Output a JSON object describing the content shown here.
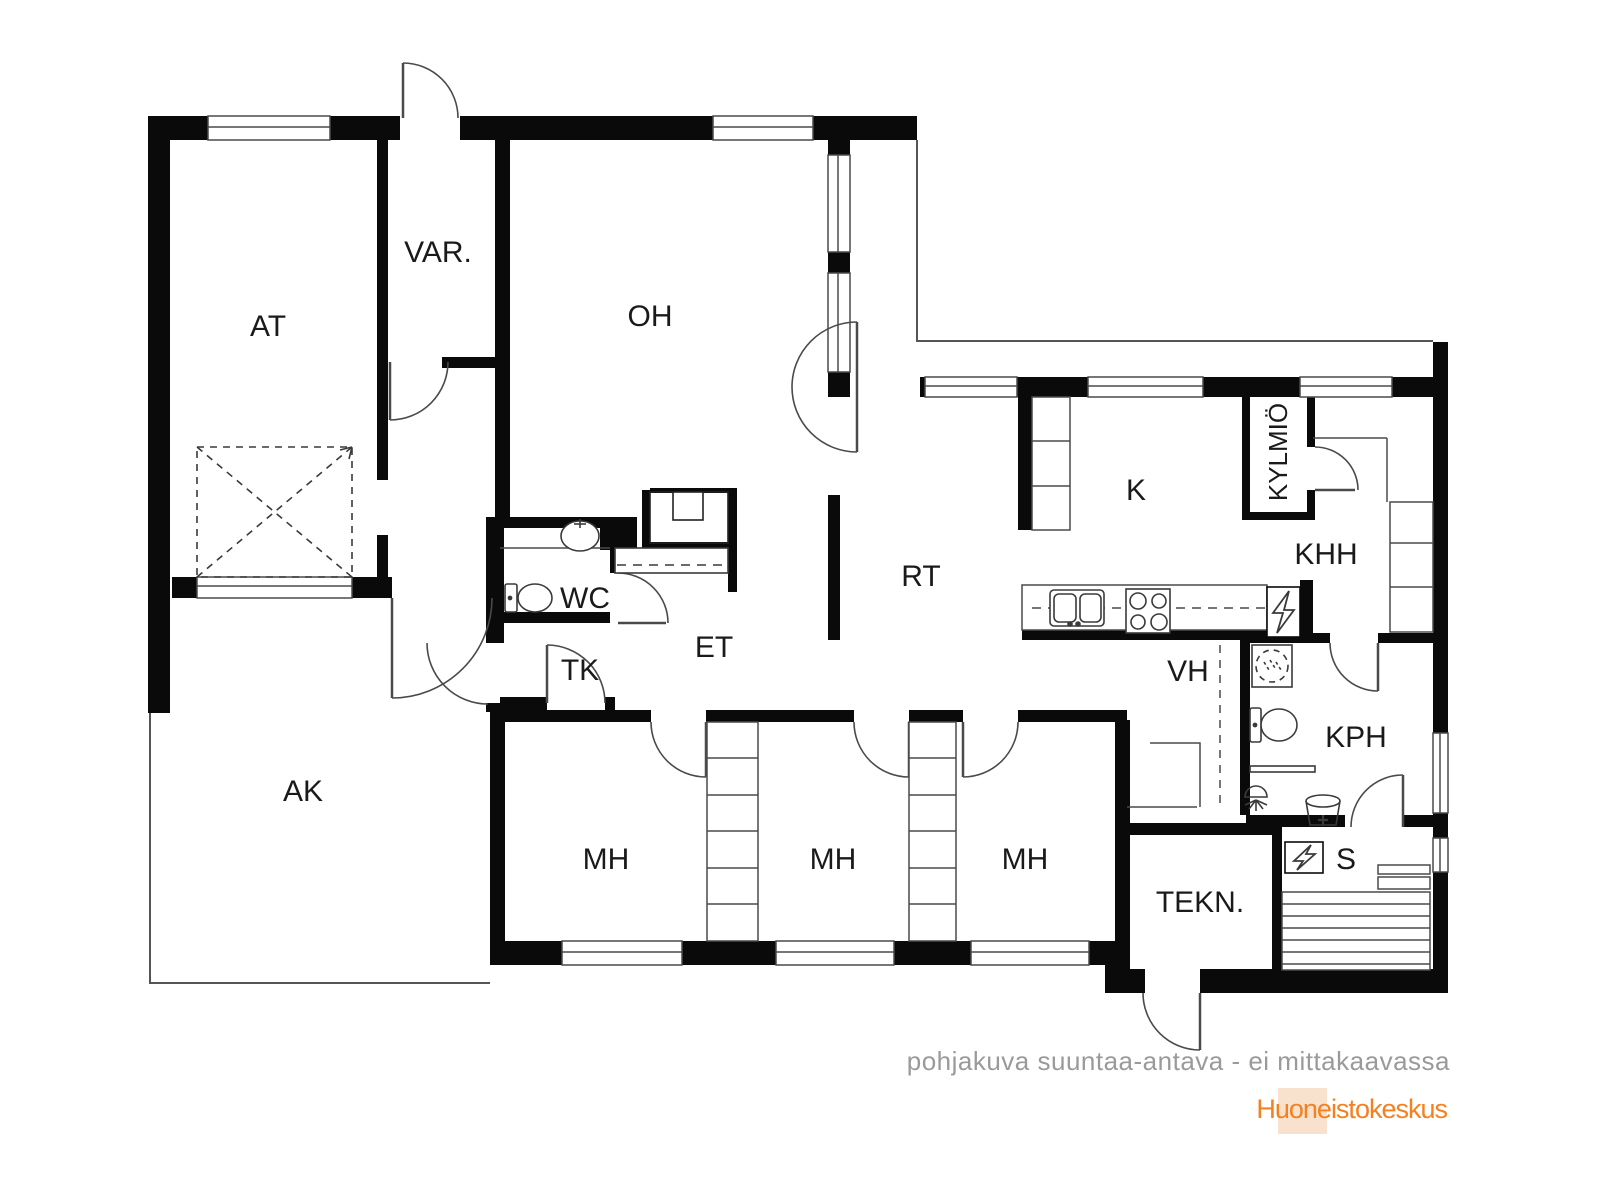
{
  "floor_plan": {
    "rooms": [
      {
        "id": "at",
        "label": "AT"
      },
      {
        "id": "var",
        "label": "VAR."
      },
      {
        "id": "oh",
        "label": "OH"
      },
      {
        "id": "k",
        "label": "K"
      },
      {
        "id": "kylmio",
        "label": "KYLMIÖ"
      },
      {
        "id": "khh",
        "label": "KHH"
      },
      {
        "id": "rt",
        "label": "RT"
      },
      {
        "id": "wc",
        "label": "WC"
      },
      {
        "id": "et",
        "label": "ET"
      },
      {
        "id": "tk",
        "label": "TK"
      },
      {
        "id": "vh",
        "label": "VH"
      },
      {
        "id": "kph",
        "label": "KPH"
      },
      {
        "id": "ak",
        "label": "AK"
      },
      {
        "id": "mh1",
        "label": "MH"
      },
      {
        "id": "mh2",
        "label": "MH"
      },
      {
        "id": "mh3",
        "label": "MH"
      },
      {
        "id": "tekn",
        "label": "TEKN."
      },
      {
        "id": "s",
        "label": "S"
      }
    ],
    "footer": {
      "disclaimer": "pohjakuva suuntaa-antava - ei mittakaavassa"
    },
    "logo": {
      "text": "Huoneistokeskus",
      "color": "#f58020",
      "bg": "#f9e2cd"
    },
    "colors": {
      "wall": "#0a0a0a",
      "thin_line": "#4a4a4a",
      "label": "#1a1a1a",
      "footer_text": "#9a9a9a",
      "background": "#ffffff"
    },
    "symbols": [
      "fireplace-icon",
      "toilet-icon",
      "sink-icon",
      "stove-icon",
      "electric-panel-icon",
      "washing-machine-icon",
      "shower-icon",
      "water-bucket-icon",
      "sauna-stove-icon",
      "sauna-bench-icon",
      "wardrobe-icon",
      "car-space-icon"
    ]
  }
}
